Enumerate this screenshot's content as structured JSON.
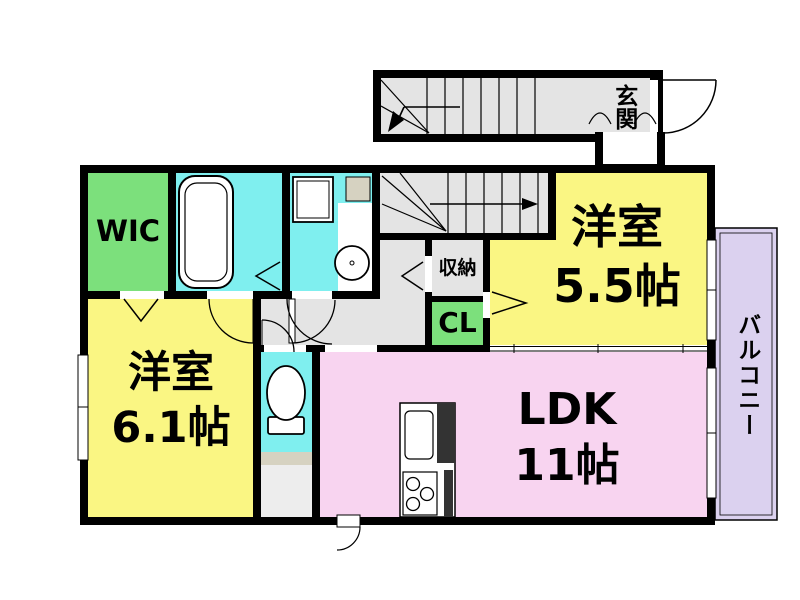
{
  "floor_plan": {
    "rooms": {
      "wic": {
        "label": "WIC"
      },
      "bedroom_a": {
        "name": "洋室",
        "size": "5.5帖"
      },
      "bedroom_b": {
        "name": "洋室",
        "size": "6.1帖"
      },
      "ldk": {
        "name": "LDK",
        "size": "11帖"
      },
      "closet": {
        "label": "CL"
      },
      "storage": {
        "label": "収納"
      },
      "entrance": {
        "label": "玄関"
      },
      "balcony": {
        "label": "バルコニー"
      }
    },
    "colors": {
      "bedroom_yellow": "#FAF683",
      "ldk_pink": "#F8D4F0",
      "closet_green": "#7CE07C",
      "wet_area_cyan": "#7FEFEF",
      "balcony_lavender": "#DBD1EF",
      "hall_gray": "#E4E4E4",
      "counter_beige": "#D6D2C1",
      "wall_black": "#000000"
    }
  }
}
